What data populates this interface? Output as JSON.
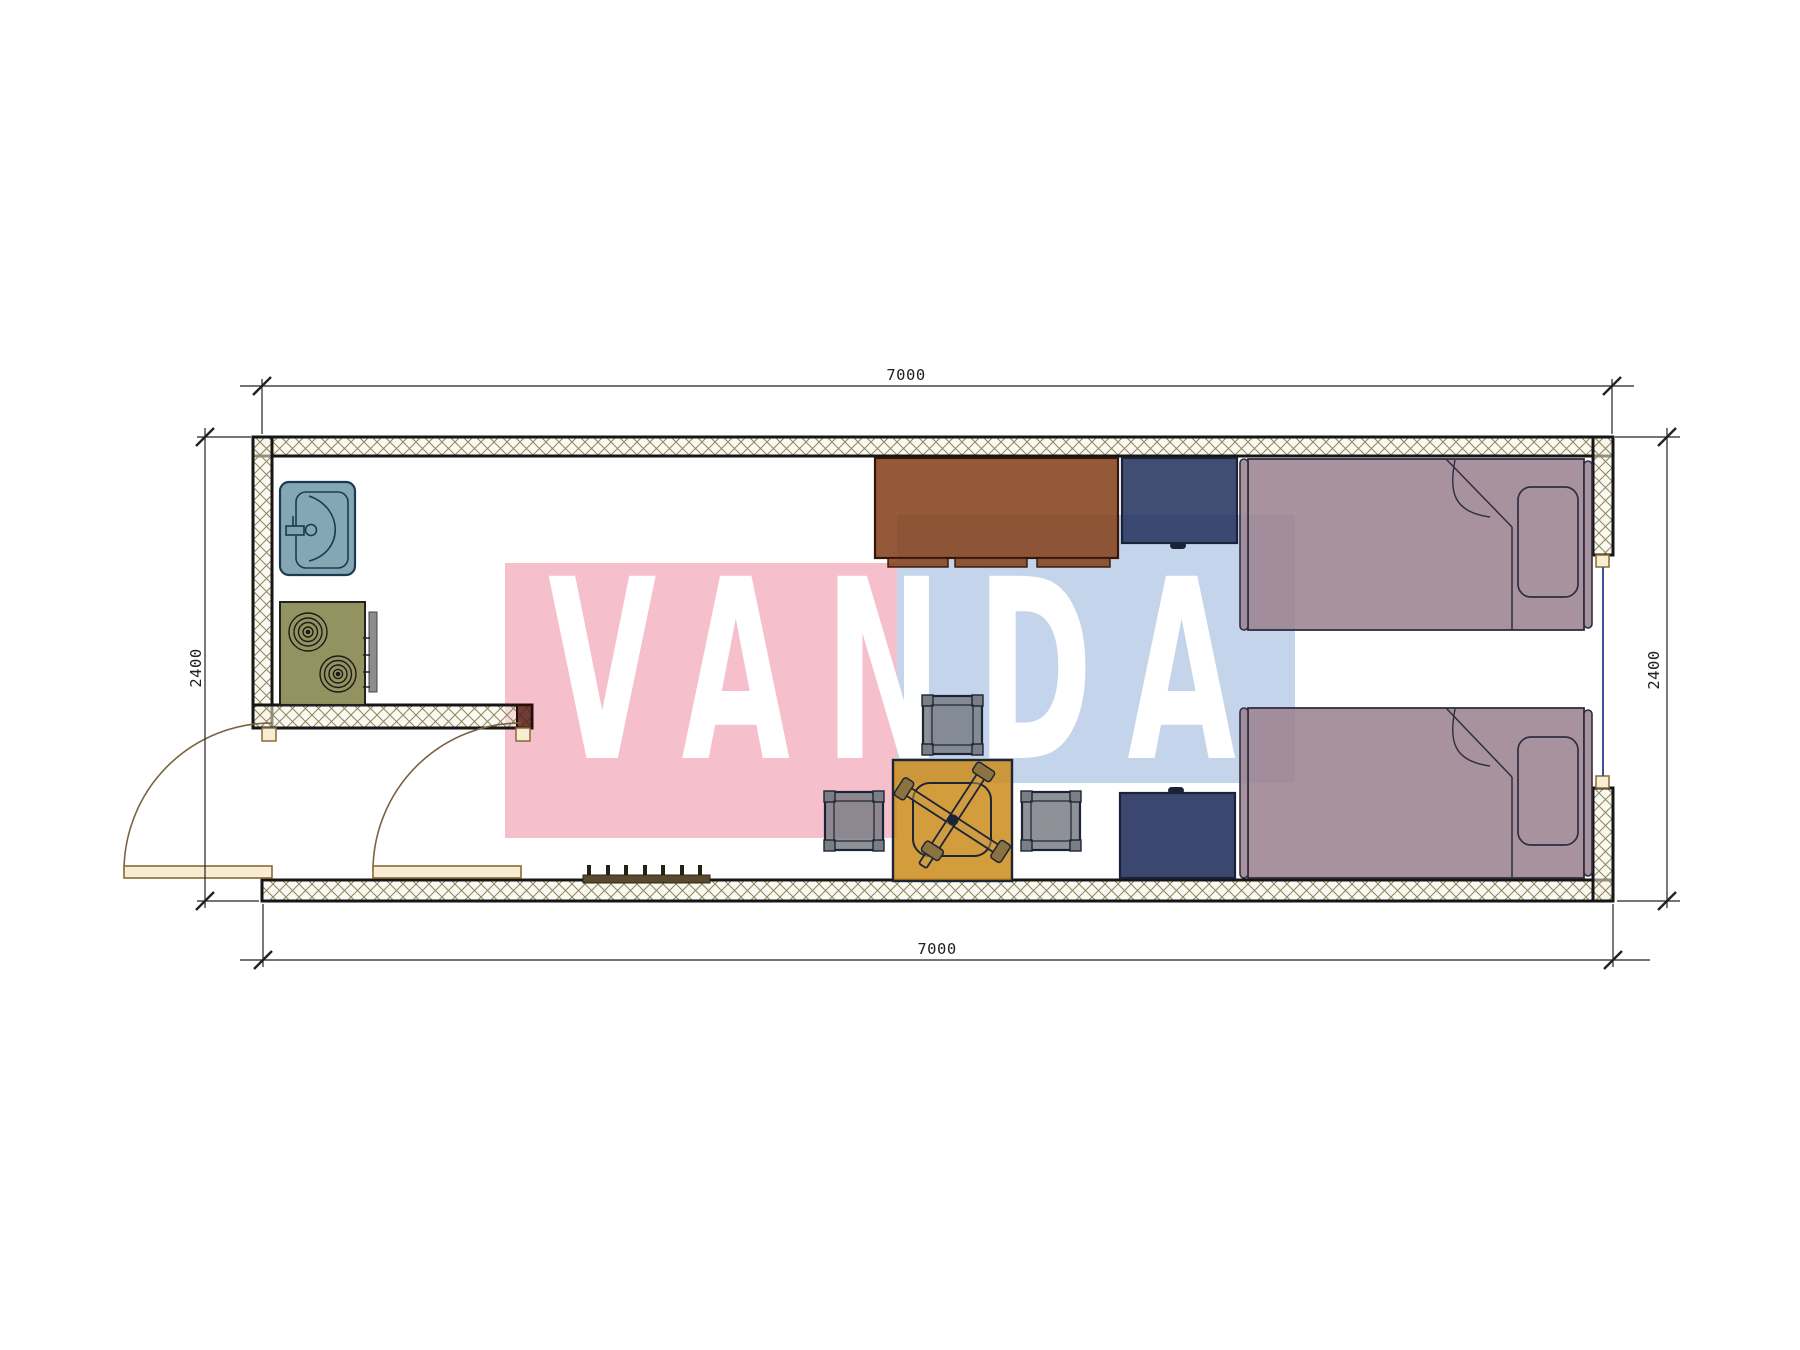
{
  "watermark": {
    "text": "VANDA"
  },
  "dimensions": {
    "top": "7000",
    "bottom": "7000",
    "left": "2400",
    "right": "2400"
  },
  "colors": {
    "watermark_pink": "#F5BFCB",
    "watermark_blue": "#C4D4EA",
    "watermark_text": "#FFFFFF",
    "wall_line": "#161616",
    "hatch_line": "#8F845A",
    "sink": "#7CA3B0",
    "stove": "#8D8D59",
    "desk": "#84401A",
    "wardrobe": "#26335F",
    "bed": "#9B828F",
    "table": "#CD8D1F",
    "stool": "#7A7E85",
    "door": "#F6EDD2",
    "window_glass": "#3A4F9A",
    "cap": "#57201A",
    "rack": "#574A2E",
    "dimension": "#222222"
  },
  "furniture": {
    "items": [
      {
        "name": "kitchen-sink"
      },
      {
        "name": "stove"
      },
      {
        "name": "study-desk"
      },
      {
        "name": "wardrobe-top"
      },
      {
        "name": "bed-1"
      },
      {
        "name": "bed-2"
      },
      {
        "name": "wardrobe-bottom"
      },
      {
        "name": "dining-table"
      },
      {
        "name": "office-chair"
      },
      {
        "name": "stool-top"
      },
      {
        "name": "stool-left"
      },
      {
        "name": "stool-right"
      },
      {
        "name": "shoe-rack"
      },
      {
        "name": "entry-door-1"
      },
      {
        "name": "entry-door-2"
      },
      {
        "name": "window"
      }
    ]
  }
}
